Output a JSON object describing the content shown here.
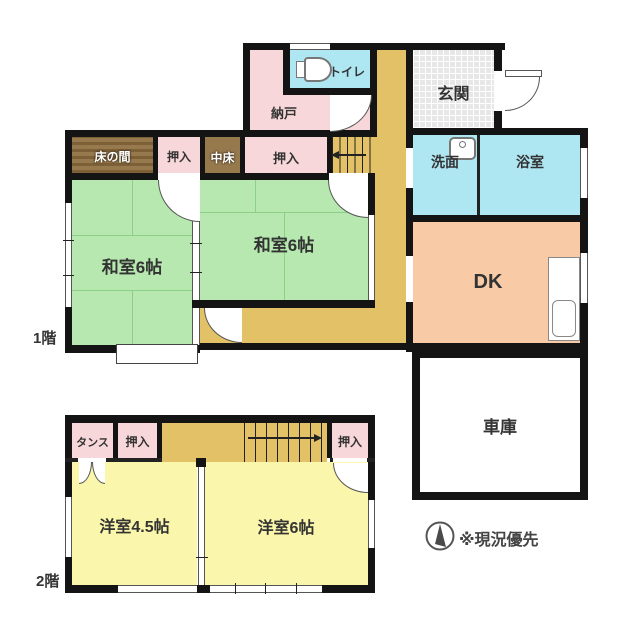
{
  "floor1": {
    "label": "1階",
    "rooms": {
      "nando": "納戸",
      "toilet": "トイレ",
      "genkan": "玄関",
      "tokonoma": "床の間",
      "oshiire_a": "押入",
      "nakadoko": "中床",
      "oshiire_b": "押入",
      "senmen": "洗面",
      "yokushitsu": "浴室",
      "washitsu_a": "和室6帖",
      "washitsu_b": "和室6帖",
      "dk": "DK",
      "shako": "車庫"
    }
  },
  "floor2": {
    "label": "2階",
    "rooms": {
      "tansu": "タンス",
      "oshiire_c": "押入",
      "oshiire_d": "押入",
      "yoshitsu_a": "洋室4.5帖",
      "yoshitsu_b": "洋室6帖"
    }
  },
  "note": "※現況優先",
  "icons": {
    "toilet": "toilet-icon",
    "sink": "sink-icon",
    "kitchen_counter": "kitchen-counter-icon",
    "compass": "compass-icon",
    "stair_arrow_down": "stair-arrow-left-icon",
    "stair_arrow_up": "stair-arrow-right-icon"
  },
  "colors": {
    "wall": "#141414",
    "closet_pink": "#f8d7da",
    "wet_area_cyan": "#aee7f2",
    "tatami_green": "#b6e8af",
    "corridor_tan": "#e3c267",
    "dk_salmon": "#f8cba6",
    "western_yellow": "#faf6ab",
    "wood_brown": "#97794e",
    "entrance_tile": "#e7e7e7"
  }
}
